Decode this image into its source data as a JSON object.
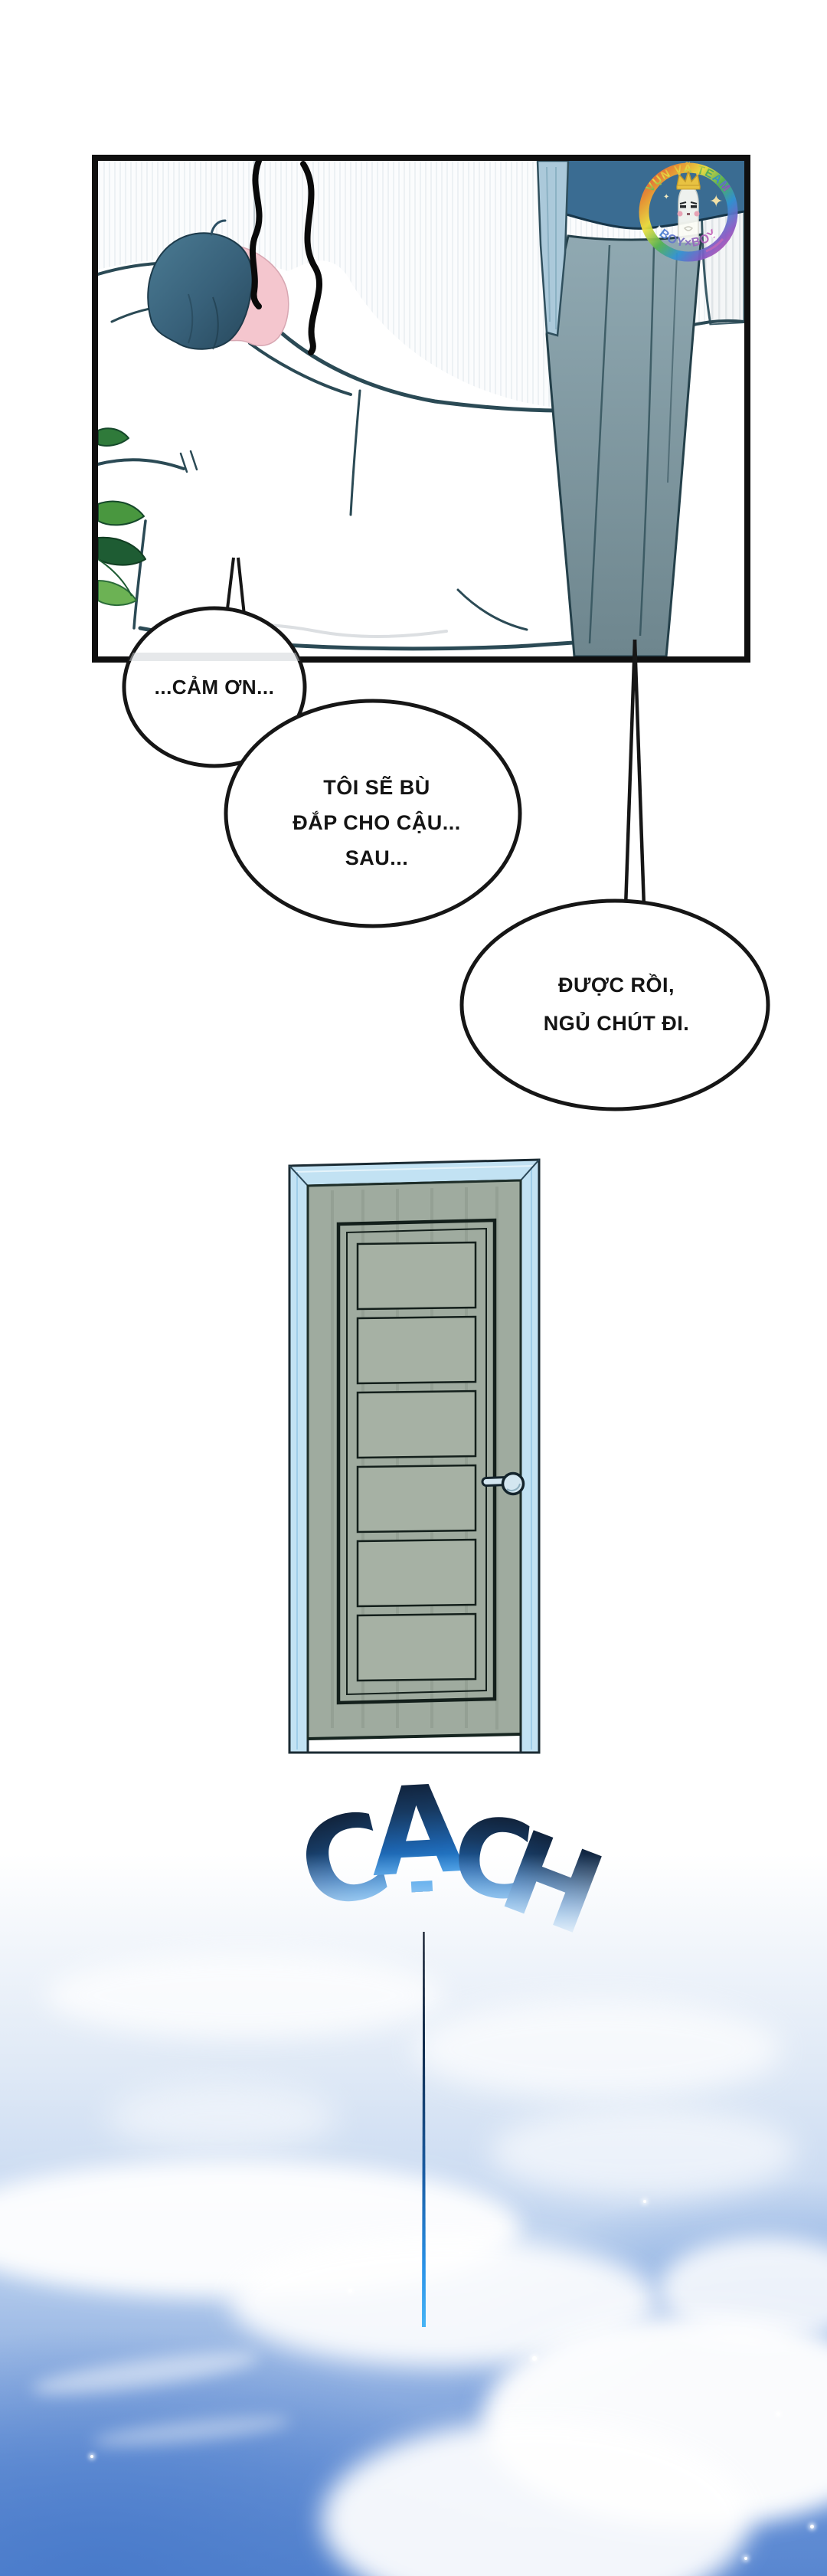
{
  "page": {
    "kind": "webtoon-comic-page",
    "background": "#ffffff"
  },
  "panel": {
    "description": "character sleeping in bed while another person stands beside the bed",
    "outline_color": "#0f0f0f",
    "hair_color": "#38617a",
    "skin_color": "#f4c6ce",
    "pants_color": "#7e969e",
    "shirt_color": "#3a6c92",
    "plant_color": "#49973f"
  },
  "watermark": {
    "team_name": "VỤN VÃ TEAM",
    "tagline": "BOY×BOY",
    "ring_colors": [
      "#e5443c",
      "#f2972f",
      "#f5e23c",
      "#55b450",
      "#3193d4",
      "#8757c4",
      "#e0509f"
    ]
  },
  "bubbles": {
    "b1": {
      "lines": [
        "...CẢM ƠN..."
      ]
    },
    "b2": {
      "lines": [
        "TÔI SẼ BÙ",
        "ĐẮP CHO CẬU...",
        "SAU..."
      ]
    },
    "b3": {
      "lines": [
        "ĐƯỢC RỒI,",
        "NGỦ CHÚT ĐI."
      ]
    }
  },
  "door": {
    "frame_color": "#c2e2f3",
    "slab_color": "#9fab9f",
    "panel_count": 6
  },
  "sfx": {
    "word": "CẠCH",
    "letters": [
      "C",
      "Ạ",
      "C",
      "H"
    ],
    "gradient_top": "#0f1c30",
    "gradient_bottom": "#2b93e8"
  },
  "sky": {
    "base_color": "#5886d0",
    "cloud_color": "#ffffff"
  }
}
